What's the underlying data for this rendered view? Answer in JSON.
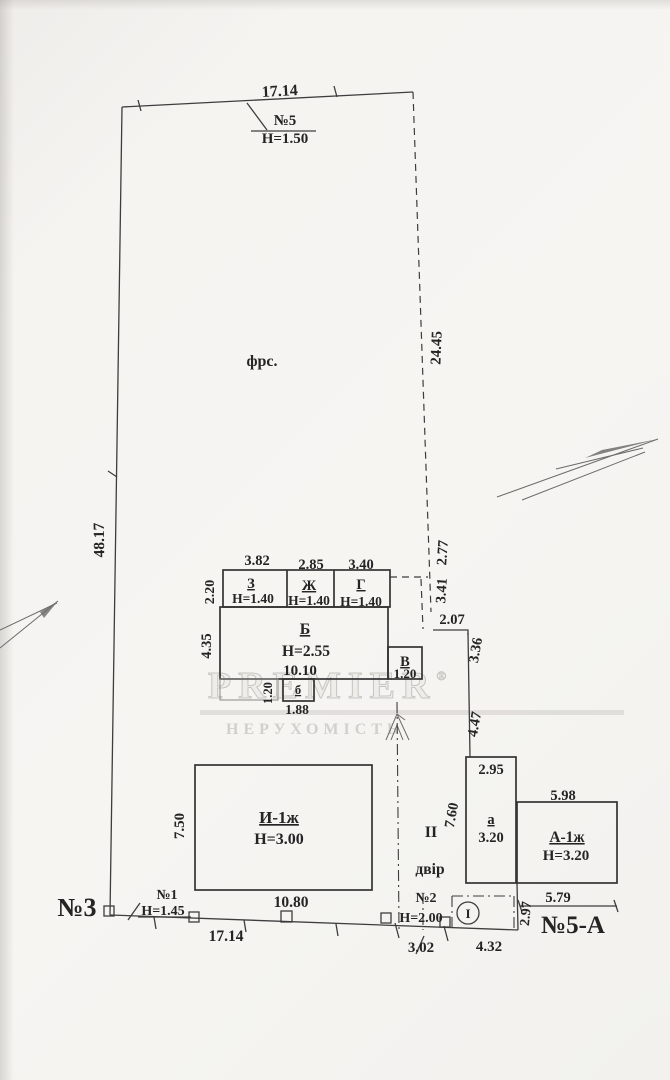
{
  "watermark": {
    "brand": "PREMIER",
    "reg": "®",
    "subtitle": "НЕРУХОМІСТЬ"
  },
  "site": {
    "top_width": "17.14",
    "left_length": "48.17",
    "right_length": "24.45",
    "area_label": "фрс.",
    "neighbor_top": {
      "num": "№5",
      "height": "Н=1.50"
    },
    "right_steps": {
      "s1": "2.77",
      "s2": "3.41",
      "s3": "2.07",
      "s4": "3.36",
      "s5": "4.47"
    }
  },
  "outbuilding": {
    "top_rooms": [
      {
        "letter": "З",
        "height": "Н=1.40",
        "width": "3.82"
      },
      {
        "letter": "Ж",
        "height": "Н=1.40",
        "width": "2.85"
      },
      {
        "letter": "Г",
        "height": "Н=1.40",
        "width": "3.40"
      }
    ],
    "row_side": "2.20",
    "main": {
      "letter": "Б",
      "height": "Н=2.55",
      "width": "10.10",
      "side": "4.35"
    },
    "annex_v": {
      "letter": "В",
      "width": "1.20"
    },
    "annex_b": {
      "letter": "б",
      "width": "1.88",
      "side": "1.20"
    }
  },
  "house_i": {
    "label": "И-1ж",
    "height": "Н=3.00",
    "width": "10.80",
    "side": "7.50"
  },
  "yard": {
    "section": "ІІ",
    "label": "двір",
    "side": "7.60"
  },
  "annex_a": {
    "letter": "а",
    "value": "3.20",
    "width": "2.95"
  },
  "house_a": {
    "label": "А-1ж",
    "height": "Н=3.20",
    "width_top": "5.98",
    "width_bottom": "5.79",
    "side": "2.97"
  },
  "bottom": {
    "neighbor_left": "№3",
    "gate1": {
      "num": "№1",
      "height": "Н=1.45"
    },
    "frontage": "17.14",
    "gate2": {
      "num": "№2",
      "height": "Н=2.00"
    },
    "dim_302": "3.02",
    "dim_432": "4.32",
    "entry_mark": "І",
    "neighbor_right": "№5-А"
  }
}
